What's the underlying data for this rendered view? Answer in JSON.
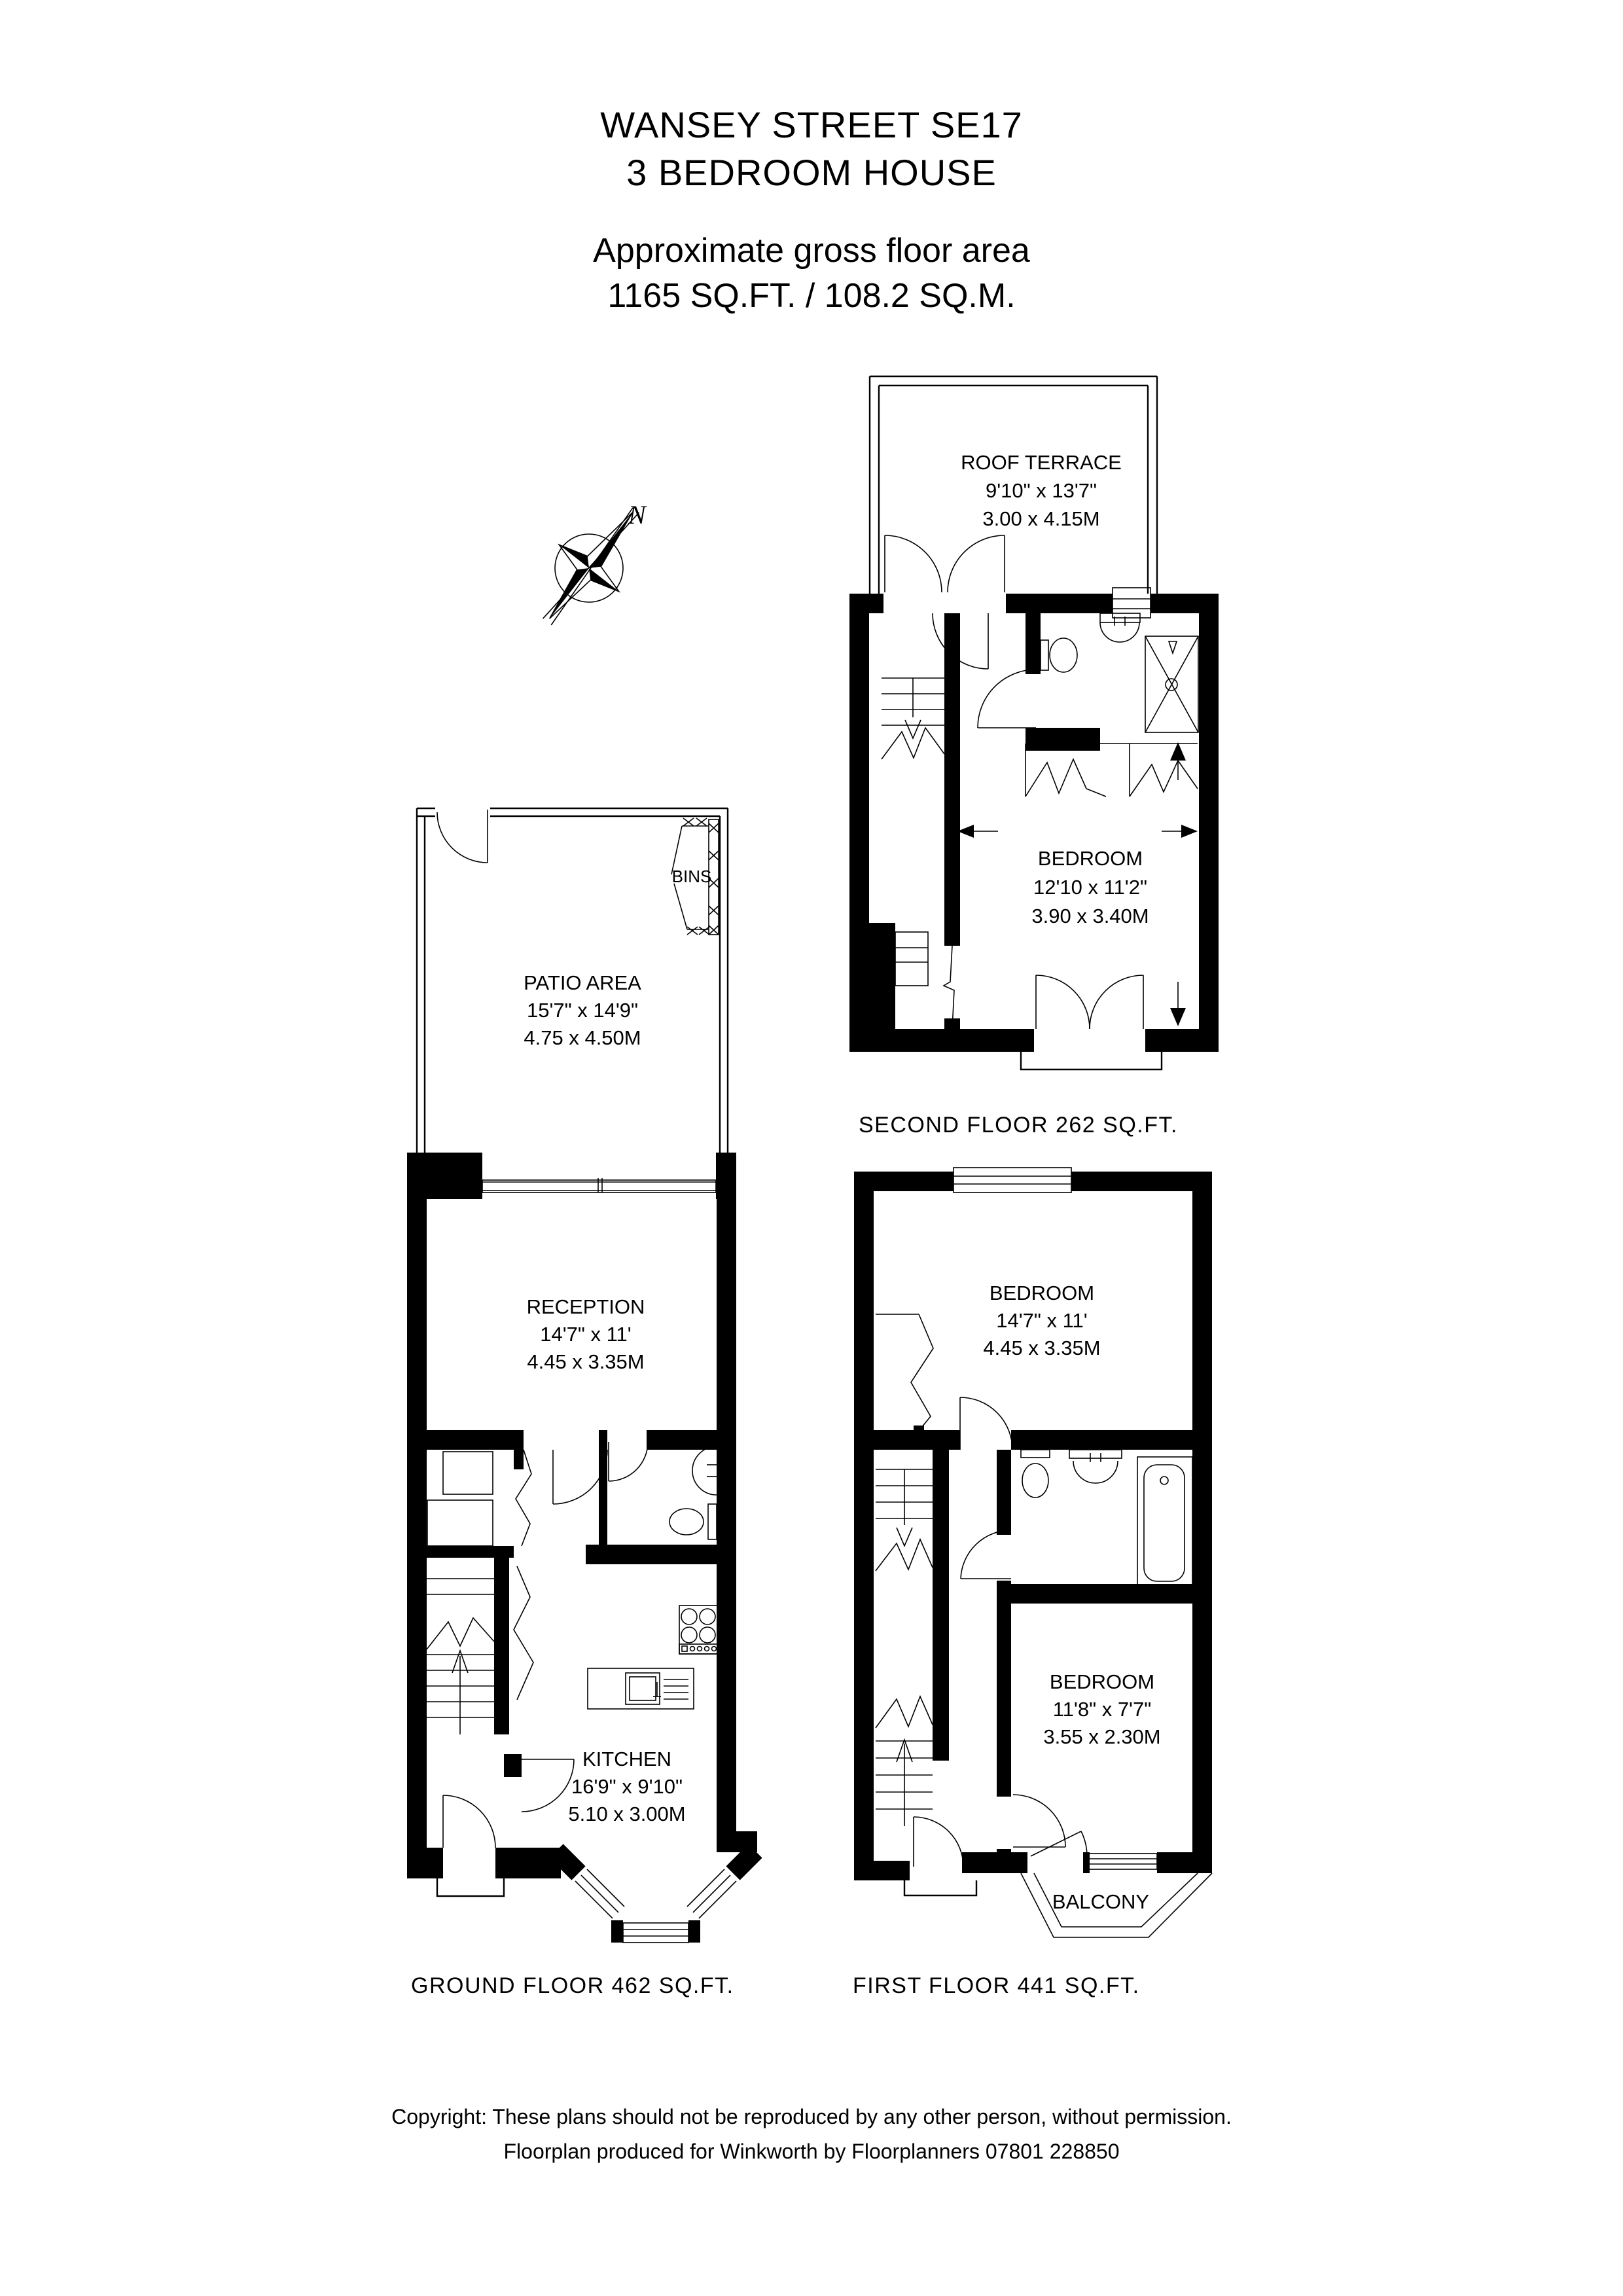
{
  "header": {
    "title_line1": "WANSEY STREET SE17",
    "title_line2": "3 BEDROOM HOUSE",
    "subtitle_line1": "Approximate gross floor area",
    "subtitle_line2": "1165 SQ.FT. / 108.2 SQ.M."
  },
  "compass": {
    "north_label": "N"
  },
  "floors": {
    "second": {
      "caption": "SECOND FLOOR 262 SQ.FT.",
      "rooms": {
        "roof_terrace": {
          "name": "ROOF TERRACE",
          "dim_imperial": "9'10\" x 13'7\"",
          "dim_metric": "3.00 x 4.15M"
        },
        "bedroom": {
          "name": "BEDROOM",
          "dim_imperial": "12'10 x 11'2\"",
          "dim_metric": "3.90 x 3.40M"
        }
      }
    },
    "ground": {
      "caption": "GROUND FLOOR 462 SQ.FT.",
      "rooms": {
        "patio": {
          "name": "PATIO AREA",
          "dim_imperial": "15'7\" x 14'9\"",
          "dim_metric": "4.75 x 4.50M"
        },
        "bins": {
          "name": "BINS"
        },
        "reception": {
          "name": "RECEPTION",
          "dim_imperial": "14'7\" x 11'",
          "dim_metric": "4.45 x 3.35M"
        },
        "kitchen": {
          "name": "KITCHEN",
          "dim_imperial": "16'9\" x 9'10\"",
          "dim_metric": "5.10 x 3.00M"
        }
      }
    },
    "first": {
      "caption": "FIRST FLOOR 441 SQ.FT.",
      "rooms": {
        "bedroom_front": {
          "name": "BEDROOM",
          "dim_imperial": "14'7\" x 11'",
          "dim_metric": "4.45 x 3.35M"
        },
        "bedroom_rear": {
          "name": "BEDROOM",
          "dim_imperial": "11'8\" x 7'7\"",
          "dim_metric": "3.55 x 2.30M"
        },
        "balcony": {
          "name": "BALCONY"
        }
      }
    }
  },
  "footer": {
    "line1": "Copyright: These plans should not be reproduced by any other person, without permission.",
    "line2": "Floorplan produced for Winkworth by Floorplanners 07801 228850"
  }
}
